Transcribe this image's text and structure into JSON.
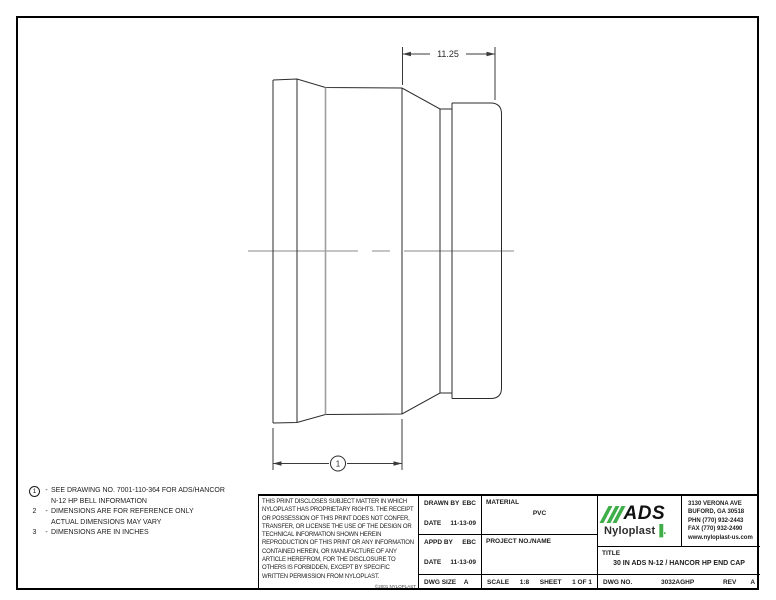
{
  "drawing": {
    "dimension_top": "11.25",
    "balloon_label": "1",
    "line_color": "#2b2b2b",
    "hidden_line_color": "#9e9e9e"
  },
  "notes": {
    "n1": {
      "num": "1",
      "dash": "-",
      "line1": "SEE DRAWING NO. 7001-110-364 FOR ADS/HANCOR",
      "line2": "N-12 HP BELL INFORMATION"
    },
    "n2": {
      "num": "2",
      "dash": "-",
      "line1": "DIMENSIONS ARE FOR REFERENCE ONLY",
      "line2": "ACTUAL DIMENSIONS MAY VARY"
    },
    "n3": {
      "num": "3",
      "dash": "-",
      "line1": "DIMENSIONS ARE IN INCHES"
    }
  },
  "legal": {
    "text": "THIS PRINT DISCLOSES SUBJECT MATTER IN WHICH NYLOPLAST HAS PROPRIETARY RIGHTS. THE RECEIPT OR POSSESSION OF THIS PRINT DOES NOT CONFER, TRANSFER, OR LICENSE THE USE OF THE DESIGN OR TECHNICAL INFORMATION SHOWN HEREIN REPRODUCTION OF THIS PRINT OR ANY INFORMATION CONTAINED HEREIN, OR MANUFACTURE OF ANY ARTICLE HEREFROM, FOR THE DISCLOSURE TO OTHERS IS FORBIDDEN, EXCEPT BY SPECIFIC WRITTEN PERMISSION FROM NYLOPLAST.",
    "copyright": "©2001 NYLOPLAST"
  },
  "title_block": {
    "drawn_by_label": "DRAWN BY",
    "drawn_by": "EBC",
    "date1_label": "DATE",
    "date1": "11-13-09",
    "appd_by_label": "APPD BY",
    "appd_by": "EBC",
    "date2_label": "DATE",
    "date2": "11-13-09",
    "dwg_size_label": "DWG SIZE",
    "dwg_size": "A",
    "material_label": "MATERIAL",
    "material": "PVC",
    "project_label": "PROJECT NO./NAME",
    "scale_label": "SCALE",
    "scale": "1:8",
    "sheet_label": "SHEET",
    "sheet": "1 OF 1",
    "title_label": "TITLE",
    "title": "30 IN ADS N-12 / HANCOR HP END CAP",
    "dwg_no_label": "DWG NO.",
    "dwg_no": "3032AGHP",
    "rev_label": "REV",
    "rev": "A"
  },
  "company": {
    "name_ads": "ADS",
    "name_nyloplast": "Nyloplast",
    "accent_color": "#3fae49",
    "address_line1": "3130 VERONA AVE",
    "address_line2": "BUFORD, GA 30518",
    "address_line3": "PHN (770) 932-2443",
    "address_line4": "FAX (770) 932-2490",
    "address_line5": "www.nyloplast-us.com"
  }
}
